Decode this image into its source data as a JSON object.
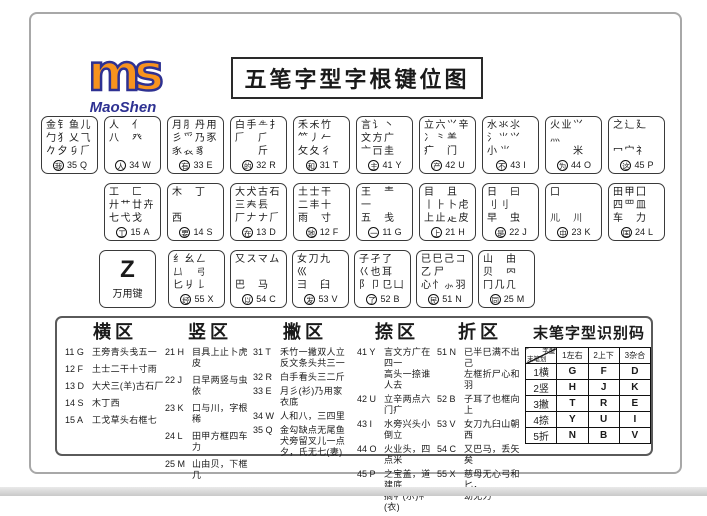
{
  "logo": {
    "mark": "ms",
    "name": "MaoShen"
  },
  "title": "五笔字型字根键位图",
  "keyboard": {
    "z_key": {
      "letter": "Z",
      "label": "万用键"
    },
    "rows": [
      [
        {
          "letter": "Q",
          "code": "35",
          "freq": "我",
          "roots": [
            "金钅鱼儿",
            "勹犭乂⺄",
            "𠂊夕𠂎𠂆"
          ]
        },
        {
          "letter": "W",
          "code": "34",
          "freq": "人",
          "roots": [
            "人　亻",
            "八　癶",
            "𡕒　𠆢"
          ]
        },
        {
          "letter": "E",
          "code": "33",
          "freq": "有",
          "roots": [
            "月⺼丹用",
            "彡⺤乃豕",
            "𧰨𧘇豸"
          ]
        },
        {
          "letter": "R",
          "code": "32",
          "freq": "的",
          "roots": [
            "白手𠂒扌",
            "𠂆　⺁",
            "　　斤"
          ]
        },
        {
          "letter": "T",
          "code": "31",
          "freq": "和",
          "roots": [
            "禾𥝌竹",
            "⺮丿𠂉",
            "攵夂彳"
          ]
        },
        {
          "letter": "Y",
          "code": "41",
          "freq": "主",
          "roots": [
            "言讠丶",
            "文方广",
            "亠𠮛圭"
          ]
        },
        {
          "letter": "U",
          "code": "42",
          "freq": "产",
          "roots": [
            "立六⺍辛",
            "冫⺀⺷",
            "疒　门"
          ]
        },
        {
          "letter": "I",
          "code": "43",
          "freq": "不",
          "roots": [
            "水氺⺢",
            "氵⺌⺍",
            "小𡭔⺌"
          ]
        },
        {
          "letter": "O",
          "code": "44",
          "freq": "为",
          "roots": [
            "火业𭕄",
            "灬",
            "　　米"
          ]
        },
        {
          "letter": "P",
          "code": "45",
          "freq": "这",
          "roots": [
            "之辶廴",
            "",
            "冖宀礻"
          ]
        }
      ],
      [
        {
          "letter": "A",
          "code": "15",
          "freq": "工",
          "roots": [
            "工　匚",
            "廾艹廿𠦄",
            "七弋戈"
          ]
        },
        {
          "letter": "S",
          "code": "14",
          "freq": "要",
          "roots": [
            "木　丁",
            "",
            "西"
          ]
        },
        {
          "letter": "D",
          "code": "13",
          "freq": "在",
          "roots": [
            "大犬古石",
            "三𡗗镸",
            "厂𠂇ナ𠂆"
          ]
        },
        {
          "letter": "F",
          "code": "12",
          "freq": "地",
          "roots": [
            "土士干",
            "二丰十",
            "雨　寸"
          ]
        },
        {
          "letter": "G",
          "code": "11",
          "freq": "一",
          "roots": [
            "王　龶",
            "一",
            "五　戋"
          ]
        },
        {
          "letter": "H",
          "code": "21",
          "freq": "上",
          "roots": [
            "目　且",
            "丨⺊卜虍",
            "上止龰皮"
          ]
        },
        {
          "letter": "J",
          "code": "22",
          "freq": "是",
          "roots": [
            "日　曰",
            "刂⺉𠁡",
            "早　虫"
          ]
        },
        {
          "letter": "K",
          "code": "23",
          "freq": "中",
          "roots": [
            "口",
            "",
            "𫶧　川"
          ]
        },
        {
          "letter": "L",
          "code": "24",
          "freq": "国",
          "roots": [
            "田甲囗",
            "四罒皿",
            "车　力"
          ]
        }
      ],
      [
        {
          "letter": "X",
          "code": "55",
          "freq": "经",
          "roots": [
            "纟幺𠃋",
            "𠙴　弓",
            "匕𠂈𠄌"
          ]
        },
        {
          "letter": "C",
          "code": "54",
          "freq": "以",
          "roots": [
            "又スマム",
            "",
            "巴　马"
          ]
        },
        {
          "letter": "V",
          "code": "53",
          "freq": "发",
          "roots": [
            "女刀九",
            "巛",
            "彐　臼"
          ]
        },
        {
          "letter": "B",
          "code": "52",
          "freq": "了",
          "roots": [
            "子孑了",
            "巜也耳",
            "阝卩㔾凵"
          ]
        },
        {
          "letter": "N",
          "code": "51",
          "freq": "民",
          "roots": [
            "已巳己コ",
            "乙𠂋尸",
            "心忄⺗羽"
          ]
        },
        {
          "letter": "M",
          "code": "25",
          "freq": "同",
          "roots": [
            "山　由",
            "贝　𠔿",
            "冂几𠘧"
          ]
        }
      ]
    ]
  },
  "zones": [
    {
      "title": "横区",
      "items": [
        {
          "code": "11 G",
          "text": "王旁青头戋五一"
        },
        {
          "code": "12 F",
          "text": "土士二干十寸雨"
        },
        {
          "code": "13 D",
          "text": "大犬三(羊)古石厂"
        },
        {
          "code": "14 S",
          "text": "木丁西"
        },
        {
          "code": "15 A",
          "text": "工戈草头右框七"
        }
      ]
    },
    {
      "title": "竖区",
      "items": [
        {
          "code": "21 H",
          "text": "目具上止卜虎皮"
        },
        {
          "code": "22 J",
          "text": "日早两竖与虫依"
        },
        {
          "code": "23 K",
          "text": "口与川，字根稀"
        },
        {
          "code": "24 L",
          "text": "田甲方框四车力"
        },
        {
          "code": "25 M",
          "text": "山由贝，下框几"
        }
      ]
    },
    {
      "title": "撇区",
      "items": [
        {
          "code": "31 T",
          "text": "禾竹一撇双人立\n反文条头共三一"
        },
        {
          "code": "32 R",
          "text": "白手看头三二斤"
        },
        {
          "code": "33 E",
          "text": "月彡(衫)乃用家\n衣底"
        },
        {
          "code": "34 W",
          "text": "人和八，三四里"
        },
        {
          "code": "35 Q",
          "text": "金勾缺点无尾鱼\n犬旁留叉儿一点\n夕，氏无七(妻)"
        }
      ]
    },
    {
      "title": "捺区",
      "items": [
        {
          "code": "41 Y",
          "text": "言文方广在四一\n高头一捺谁人去"
        },
        {
          "code": "42 U",
          "text": "立辛两点六门疒"
        },
        {
          "code": "43 I",
          "text": "水旁兴头小倒立"
        },
        {
          "code": "44 O",
          "text": "火业头，四点米"
        },
        {
          "code": "45 P",
          "text": "之宝盖，道建底\n摘礻(示)衤(衣)"
        }
      ]
    },
    {
      "title": "折区",
      "items": [
        {
          "code": "51 N",
          "text": "已半巳满不出己\n左框折尸心和羽"
        },
        {
          "code": "52 B",
          "text": "子耳了也框向上"
        },
        {
          "code": "53 V",
          "text": "女刀九臼山朝西"
        },
        {
          "code": "54 C",
          "text": "又巴马，丢矢矣"
        },
        {
          "code": "55 X",
          "text": "慈母无心弓和匕，\n幼无力"
        }
      ]
    }
  ],
  "recognition_table": {
    "title": "末笔字型识别码",
    "corner": {
      "top": "字型",
      "bottom": "末笔划"
    },
    "columns": [
      "1左右",
      "2上下",
      "3杂合"
    ],
    "rows": [
      {
        "label": "1横",
        "cells": [
          "G",
          "F",
          "D"
        ]
      },
      {
        "label": "2竖",
        "cells": [
          "H",
          "J",
          "K"
        ]
      },
      {
        "label": "3撇",
        "cells": [
          "T",
          "R",
          "E"
        ]
      },
      {
        "label": "4捺",
        "cells": [
          "Y",
          "U",
          "I"
        ]
      },
      {
        "label": "5折",
        "cells": [
          "N",
          "B",
          "V"
        ]
      }
    ]
  },
  "colors": {
    "logo_orange": "#F7931E",
    "logo_blue": "#2E3192"
  }
}
